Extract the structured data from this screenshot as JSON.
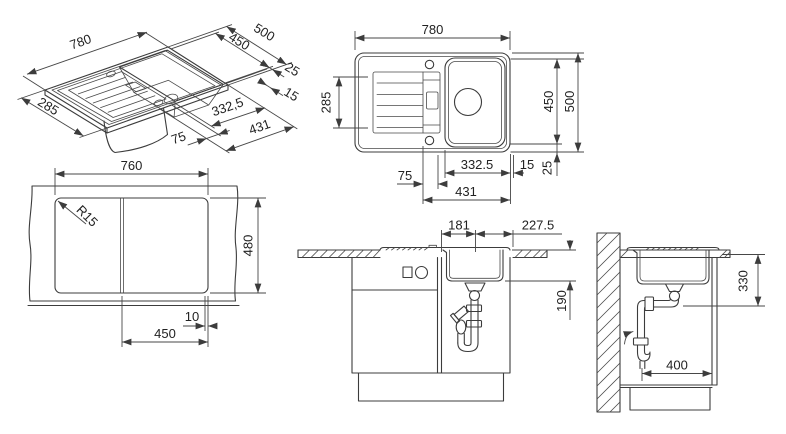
{
  "meta": {
    "background": "#ffffff",
    "line_color": "#3c3c3c"
  },
  "iso": {
    "width": "780",
    "depth": "285",
    "side_outer": "500",
    "side_inner": "450",
    "side_gap": "25",
    "rim": "15",
    "left_offset": "75",
    "bowl_center": "332,5",
    "bowl_total": "431"
  },
  "plan": {
    "width": "780",
    "drainboard": "285",
    "height_inner": "450",
    "height_outer": "500",
    "left_offset": "75",
    "bowl_center": "332.5",
    "rim": "15",
    "gap": "25",
    "bowl_total": "431"
  },
  "cutout": {
    "width": "760",
    "corner_radius": "R15",
    "height": "480",
    "offset": "10",
    "section": "450"
  },
  "front": {
    "left": "181",
    "right": "227.5",
    "bowl_depth": "190"
  },
  "side": {
    "trap_height": "330",
    "clearance": "400"
  }
}
